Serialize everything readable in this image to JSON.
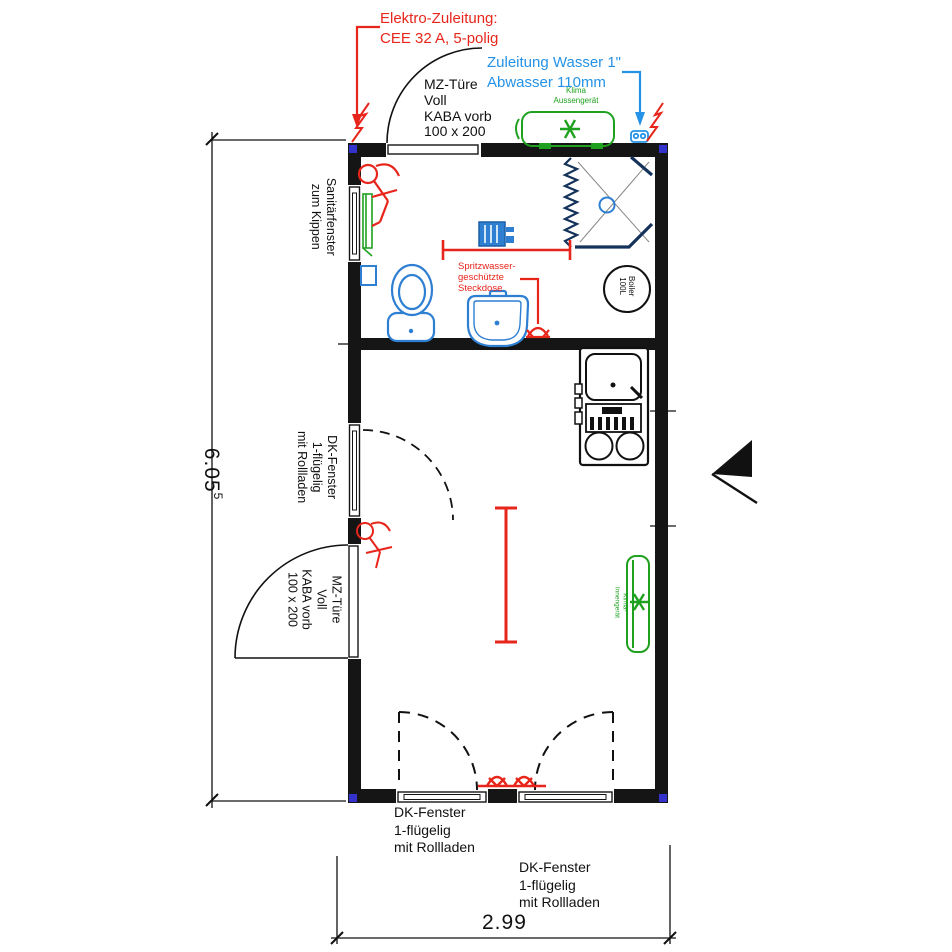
{
  "labels": {
    "elektro": "Elektro-Zuleitung:\nCEE 32 A, 5-polig",
    "wasser": "Zuleitung Wasser 1\"\nAbwasser 110mm",
    "mz_tuere_top": "MZ-Türe\nVoll\nKABA vorb\n100 x 200",
    "mz_tuere_left": "MZ-Türe\nVoll\nKABA vorb\n100 x 200",
    "sanitaerfenster": "Sanitärfenster\nzum Kippen",
    "dk_fenster_left": "DK-Fenster\n1-flügelig\nmit Rollladen",
    "dk_fenster_bottom_left": "DK-Fenster\n1-flügelig\nmit Rollladen",
    "dk_fenster_bottom_right": "DK-Fenster\n1-flügelig\nmit Rollladen",
    "steckdose": "Spritzwasser-\ngeschützte\nSteckdose",
    "klima_aussen": "Klima\nAussengerät",
    "klima_innen": "Klima-\nInnengerät",
    "boiler": "Boiler\n100L"
  },
  "dimensions": {
    "height_m": "6.05",
    "height_sup": "5",
    "width_m": "2.99"
  },
  "colors": {
    "wall": "#151515",
    "annotation_red": "#e8251b",
    "water_blue": "#2492e6",
    "fixture_blue": "#2e7fd2",
    "shower_navy": "#14325a",
    "hvac_green": "#1fa11f",
    "corner_casting_blue": "#3333cc"
  },
  "icons": {
    "klima_symbol": "asterisk-fan-icon",
    "door_hardware": "figure-symbol-icon",
    "power_socket": "socket-arc-icon",
    "lightning": "electric-flash-icon",
    "entrance": "entrance-arrow-icon"
  }
}
